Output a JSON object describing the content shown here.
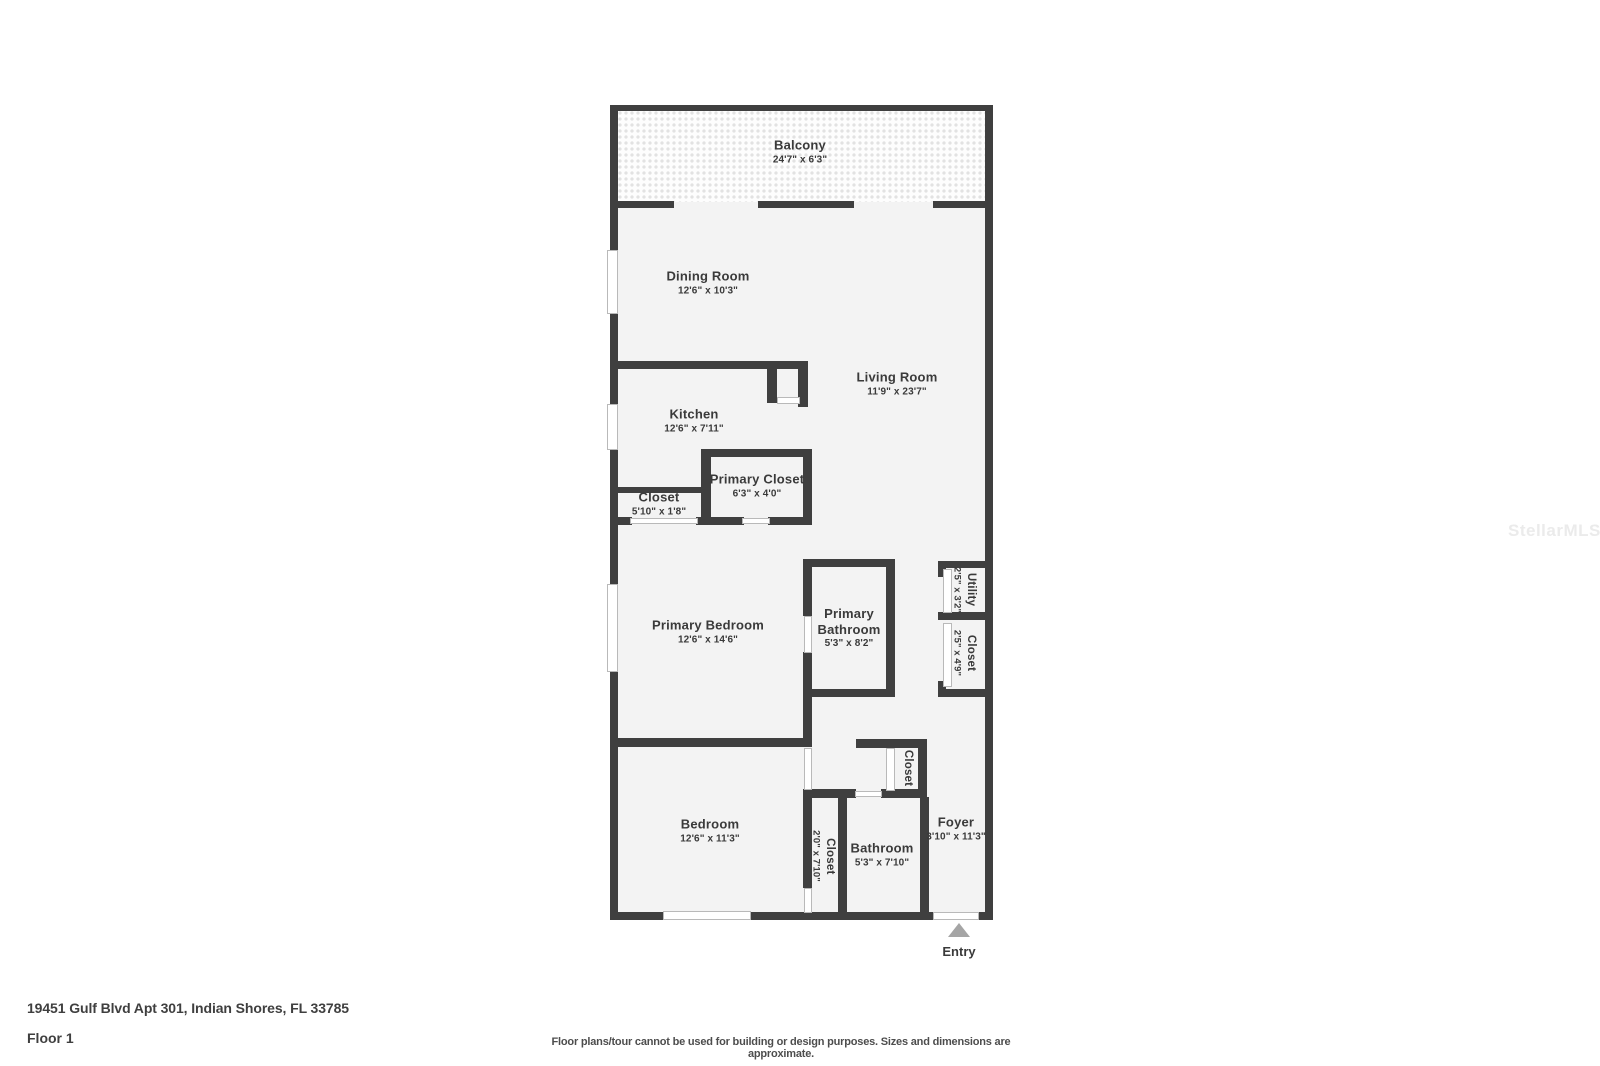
{
  "rooms": {
    "balcony": {
      "name": "Balcony",
      "dims": "24'7\" x 6'3\""
    },
    "dining_room": {
      "name": "Dining Room",
      "dims": "12'6\" x 10'3\""
    },
    "living_room": {
      "name": "Living Room",
      "dims": "11'9\" x 23'7\""
    },
    "kitchen": {
      "name": "Kitchen",
      "dims": "12'6\" x 7'11\""
    },
    "closet_hall": {
      "name": "Closet",
      "dims": "5'10\" x 1'8\""
    },
    "primary_closet": {
      "name": "Primary Closet",
      "dims": "6'3\" x 4'0\""
    },
    "primary_bedroom": {
      "name": "Primary Bedroom",
      "dims": "12'6\" x 14'6\""
    },
    "primary_bathroom": {
      "name": "Primary Bathroom",
      "dims": "5'3\" x 8'2\""
    },
    "utility": {
      "name": "Utility",
      "dims": "2'5\" x 3'2\""
    },
    "closet_utility": {
      "name": "Closet",
      "dims": "2'5\" x 4'9\""
    },
    "bedroom": {
      "name": "Bedroom",
      "dims": "12'6\" x 11'3\""
    },
    "closet_bedroom": {
      "name": "Closet",
      "dims": "2'0\" x 7'10\""
    },
    "bathroom": {
      "name": "Bathroom",
      "dims": "5'3\" x 7'10\""
    },
    "foyer": {
      "name": "Foyer",
      "dims": "3'10\" x 11'3\""
    },
    "closet_foyer": {
      "name": "Closet",
      "dims": ""
    }
  },
  "entry": {
    "label": "Entry"
  },
  "watermark": {
    "text": "StellarMLS"
  },
  "footer": {
    "address": "19451 Gulf Blvd Apt 301, Indian Shores, FL 33785",
    "floor": "Floor 1",
    "disclaimer": "Floor plans/tour cannot be used for building or design purposes. Sizes and dimensions are approximate."
  },
  "colors": {
    "wall": "#3f3f3f",
    "room_fill": "#f3f3f3",
    "balcony_dot": "#e2e2e2",
    "text": "#3a3a3a",
    "watermark": "#ebebeb",
    "entry_arrow": "#a5a5a5"
  }
}
